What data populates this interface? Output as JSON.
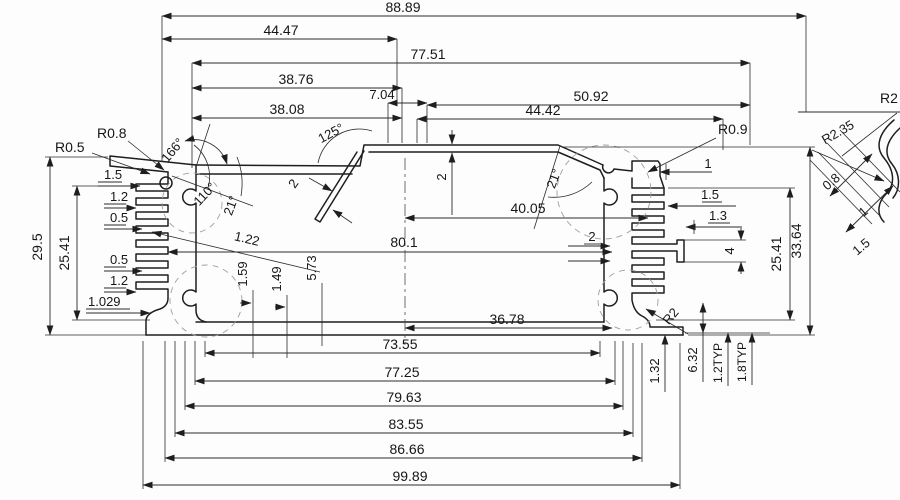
{
  "drawing": {
    "kind": "aluminum extrusion enclosure cross-section, dimensioned CAD drawing",
    "units": "mm",
    "ink_color": "#1e1e1e",
    "ghost_color": "#9f9f9f",
    "paper_color": "#fdfdfd"
  },
  "dims": {
    "top": [
      "88.89",
      "44.47",
      "77.51",
      "38.76",
      "7.04",
      "50.92",
      "38.08",
      "44.42"
    ],
    "bottom": [
      "36.78",
      "73.55",
      "77.25",
      "79.63",
      "83.55",
      "86.66",
      "99.89"
    ],
    "left_radii": [
      "R0.5",
      "R0.8"
    ],
    "left_fin": [
      "1.5",
      "1.2",
      "0.5",
      "0.5",
      "1.2",
      "1.029"
    ],
    "left_vert": [
      "29.5",
      "25.41"
    ],
    "angles": [
      "166°",
      "110°",
      "21°",
      "125°",
      "21°"
    ],
    "mid": [
      "2",
      "1.22",
      "2",
      "40.05",
      "80.1",
      "2"
    ],
    "mid_small": [
      "1.59",
      "1.49",
      "5.73"
    ],
    "right": [
      "R0.9",
      "1",
      "1.5",
      "1.3",
      "4"
    ],
    "right_vert": [
      "25.41",
      "33.64"
    ],
    "bottom_right": [
      "1.32",
      "6.32",
      "1.2TYP",
      "1.8TYP",
      "R2"
    ],
    "detail": [
      "R2",
      "R2.35",
      "0.8",
      "1",
      "1.5"
    ]
  }
}
